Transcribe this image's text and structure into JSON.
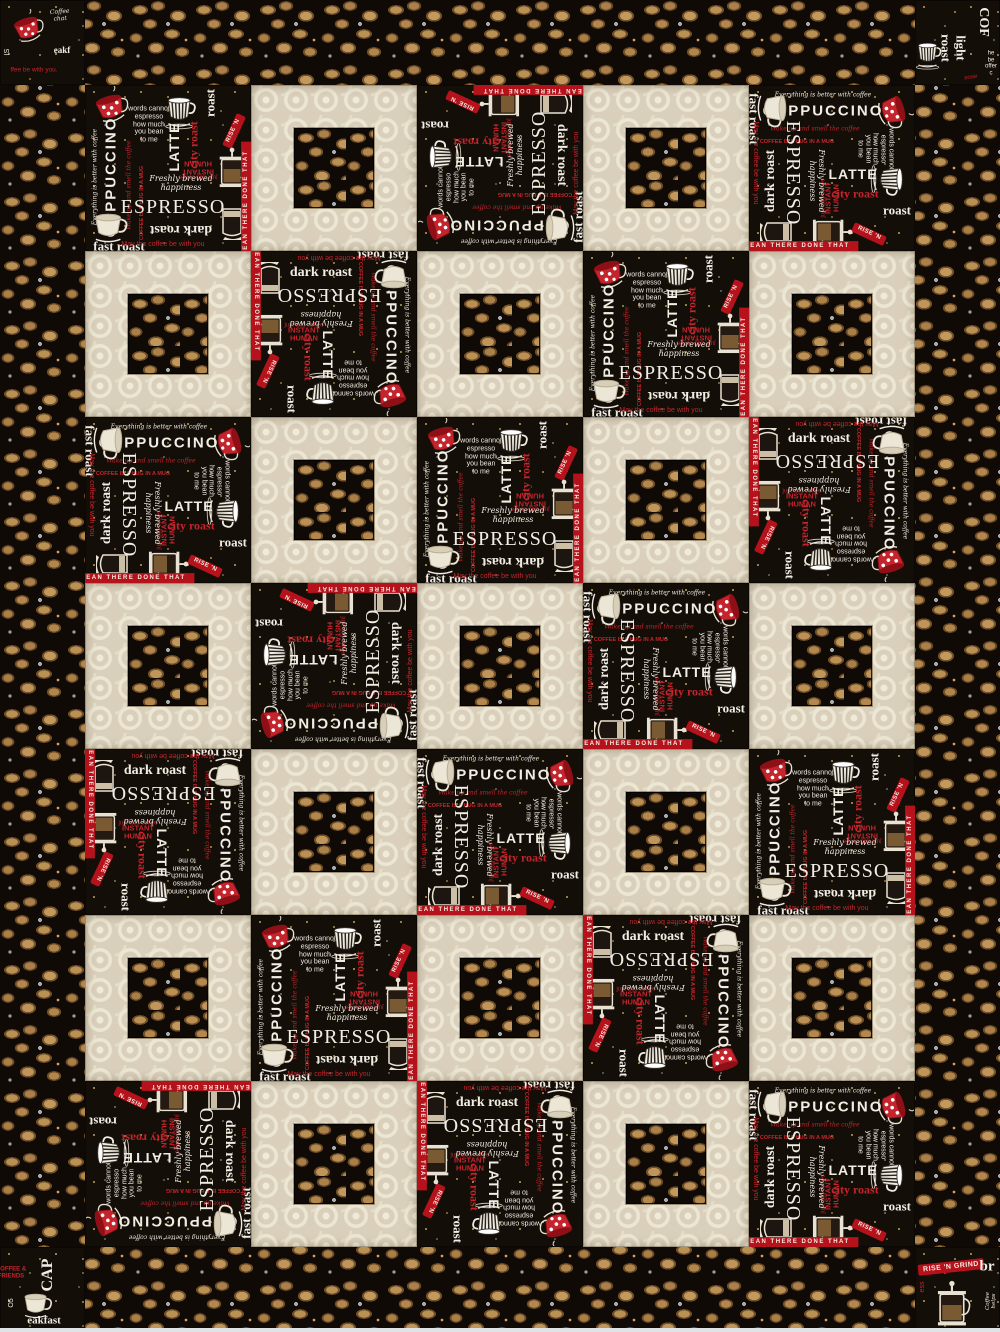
{
  "quilt": {
    "description": "Coffee-themed square-in-a-square quilt",
    "border_width_px": 85,
    "photo_edge_color": "#dfe3e6",
    "grid": {
      "cols": 5,
      "rows": 7,
      "cell_px": 166,
      "pattern": [
        "PCPCP",
        "CPCPC",
        "PCPCP",
        "CPCPC",
        "PCPCP",
        "CPCPC",
        "PCPCP"
      ],
      "orientations": [
        [
          0,
          0,
          270,
          0,
          90
        ],
        [
          0,
          180,
          0,
          0,
          0
        ],
        [
          90,
          0,
          0,
          0,
          180
        ],
        [
          0,
          270,
          0,
          90,
          0
        ],
        [
          180,
          0,
          90,
          0,
          0
        ],
        [
          0,
          0,
          0,
          180,
          0
        ],
        [
          270,
          0,
          180,
          0,
          90
        ]
      ]
    },
    "fabrics": {
      "beans": {
        "name": "coffee bean toss on black",
        "bg": "#0f0a06",
        "bean_light": "#bb9054",
        "bean_dark": "#6f4e26",
        "sprig": "#a9adb2",
        "fleck": "#c9a45e"
      },
      "cream": {
        "name": "cream tonal circle damask",
        "base": "#d9cfbb",
        "motif": "#f0ead9"
      },
      "words": {
        "name": "coffee chalkboard words on black",
        "bg": "#140e09",
        "chalk": "#f1ede3",
        "red": "#c4242b",
        "gold": "#c09a58",
        "items": [
          {
            "kind": "icon",
            "icon": "red-polka-cup",
            "x": 26,
            "y": 24,
            "size": 44,
            "rot": -10
          },
          {
            "kind": "text",
            "t": "words cannot\nespresso\nhow much\nyou bean\nto me",
            "x": 64,
            "y": 40,
            "s": 7,
            "c": "chalk",
            "f": "sans",
            "rot": 0
          },
          {
            "kind": "icon",
            "icon": "striped-cup",
            "x": 96,
            "y": 28,
            "size": 40,
            "rot": 0
          },
          {
            "kind": "text",
            "t": "LATTE",
            "x": 90,
            "y": 62,
            "s": 14,
            "c": "chalk",
            "f": "sans",
            "rot": -90,
            "w": "bold",
            "ls": 1
          },
          {
            "kind": "text",
            "t": "city roast",
            "x": 109,
            "y": 60,
            "s": 12,
            "c": "red",
            "f": "serif",
            "rot": -90,
            "w": "bold"
          },
          {
            "kind": "text",
            "t": "roast",
            "x": 126,
            "y": 18,
            "s": 13,
            "c": "chalk",
            "f": "serif",
            "rot": -90,
            "w": "bold"
          },
          {
            "kind": "banner",
            "t": "RISE 'N",
            "x": 149,
            "y": 46,
            "rot": -65,
            "s": 6
          },
          {
            "kind": "text",
            "t": "INSTANT HUMAN",
            "x": 113,
            "y": 82,
            "s": 7.5,
            "c": "red",
            "f": "sans",
            "rot": 180,
            "w": "bold"
          },
          {
            "kind": "text",
            "t": "just add coffee",
            "x": 113,
            "y": 91,
            "s": 6,
            "c": "red",
            "f": "sans",
            "rot": 180
          },
          {
            "kind": "text",
            "t": "CAPPUCCINO",
            "x": 27,
            "y": 92,
            "s": 15,
            "c": "chalk",
            "f": "sans",
            "rot": -90,
            "w": "bold",
            "ls": 2
          },
          {
            "kind": "text",
            "t": "Everything is better with coffee",
            "x": 11,
            "y": 92,
            "s": 6,
            "c": "chalk",
            "f": "script",
            "rot": -90
          },
          {
            "kind": "text",
            "t": "Wake up and smell the coffee",
            "x": 45,
            "y": 100,
            "s": 6,
            "c": "red",
            "f": "script",
            "rot": -90
          },
          {
            "kind": "text",
            "t": "COFFEE IS A HUG IN A MUG",
            "x": 57,
            "y": 118,
            "s": 5.5,
            "c": "red",
            "f": "sans",
            "rot": -90,
            "w": "bold"
          },
          {
            "kind": "text",
            "t": "Freshly brewed happiness",
            "x": 96,
            "y": 99,
            "s": 8,
            "c": "chalk",
            "f": "script",
            "rot": 0
          },
          {
            "kind": "text",
            "t": "ESPRESSO",
            "x": 88,
            "y": 122,
            "s": 20,
            "c": "chalk",
            "f": "serif",
            "rot": 0,
            "ls": 1
          },
          {
            "kind": "text",
            "t": "dark roast",
            "x": 96,
            "y": 144,
            "s": 14,
            "c": "chalk",
            "f": "serif",
            "rot": 180,
            "w": "bold"
          },
          {
            "kind": "icon",
            "icon": "french-press",
            "x": 148,
            "y": 84,
            "size": 46,
            "rot": 0
          },
          {
            "kind": "icon",
            "icon": "glass-mug",
            "x": 148,
            "y": 138,
            "size": 40,
            "rot": 0
          },
          {
            "kind": "icon",
            "icon": "white-cup",
            "x": 26,
            "y": 142,
            "size": 42,
            "rot": 0
          },
          {
            "kind": "text",
            "t": "fast roast",
            "x": 34,
            "y": 162,
            "s": 13,
            "c": "chalk",
            "f": "serif",
            "rot": 0,
            "w": "bold"
          },
          {
            "kind": "band",
            "t": "BEAN THERE DONE THAT",
            "x": 162,
            "y": 118,
            "rot": -90,
            "s": 6
          },
          {
            "kind": "text",
            "t": "May the coffee be with you",
            "x": 78,
            "y": 160,
            "s": 7,
            "c": "red",
            "f": "sans",
            "rot": 0
          }
        ]
      }
    },
    "corners": {
      "tl": {
        "items": [
          {
            "kind": "icon",
            "icon": "red-polka-cup",
            "x": 28,
            "y": 30,
            "size": 40,
            "rot": -12
          },
          {
            "kind": "text",
            "t": "Coffee chat",
            "x": 60,
            "y": 16,
            "s": 6,
            "c": "chalk",
            "f": "script",
            "rot": -4
          },
          {
            "kind": "text",
            "t": "eakf",
            "x": 62,
            "y": 50,
            "s": 9,
            "c": "chalk",
            "f": "serif",
            "rot": 0,
            "w": "bold"
          },
          {
            "kind": "text",
            "t": "ffee be with you.",
            "x": 34,
            "y": 70,
            "s": 6.5,
            "c": "red",
            "f": "sans",
            "rot": 0
          },
          {
            "kind": "text",
            "t": "IS",
            "x": 8,
            "y": 52,
            "s": 7,
            "c": "chalk",
            "f": "sans",
            "rot": -90
          }
        ]
      },
      "tr": {
        "items": [
          {
            "kind": "text",
            "t": "light roast",
            "x": 38,
            "y": 48,
            "s": 13,
            "c": "chalk",
            "f": "serif",
            "rot": 90,
            "w": "bold"
          },
          {
            "kind": "text",
            "t": "COF",
            "x": 68,
            "y": 22,
            "s": 14,
            "c": "chalk",
            "f": "serif",
            "rot": 90,
            "w": "bold"
          },
          {
            "kind": "icon",
            "icon": "striped-cup",
            "x": 14,
            "y": 56,
            "size": 34,
            "rot": 0
          },
          {
            "kind": "text",
            "t": "he be\noffer c",
            "x": 76,
            "y": 64,
            "s": 6,
            "c": "chalk",
            "f": "sans",
            "rot": 0
          },
          {
            "kind": "text",
            "t": "sose",
            "x": 56,
            "y": 78,
            "s": 6,
            "c": "red",
            "f": "script",
            "rot": -8
          }
        ]
      },
      "bl": {
        "items": [
          {
            "kind": "text",
            "t": "CAP",
            "x": 48,
            "y": 28,
            "s": 16,
            "c": "chalk",
            "f": "serif",
            "rot": -90,
            "w": "bold"
          },
          {
            "kind": "icon",
            "icon": "white-cup",
            "x": 38,
            "y": 58,
            "size": 36,
            "rot": 0
          },
          {
            "kind": "text",
            "t": "eakfast roast",
            "x": 44,
            "y": 80,
            "s": 11,
            "c": "chalk",
            "f": "serif",
            "rot": 0,
            "w": "bold"
          },
          {
            "kind": "text",
            "t": "COFFEE &\nFRIENDS",
            "x": 11,
            "y": 26,
            "s": 6,
            "c": "red",
            "f": "sans",
            "rot": 0,
            "w": "bold"
          },
          {
            "kind": "text",
            "t": "O5",
            "x": 12,
            "y": 56,
            "s": 7,
            "c": "chalk",
            "f": "sans",
            "rot": -90
          }
        ]
      },
      "br": {
        "items": [
          {
            "kind": "banner",
            "t": "RISE 'N GRIND",
            "x": 36,
            "y": 20,
            "rot": -6,
            "s": 7
          },
          {
            "kind": "text",
            "t": "br",
            "x": 72,
            "y": 20,
            "s": 15,
            "c": "chalk",
            "f": "serif",
            "rot": 0,
            "w": "bold"
          },
          {
            "kind": "icon",
            "icon": "french-press",
            "x": 38,
            "y": 58,
            "size": 52,
            "rot": 0
          },
          {
            "kind": "text",
            "t": "Coffee helps",
            "x": 76,
            "y": 54,
            "s": 5.5,
            "c": "chalk",
            "f": "script",
            "rot": -90
          },
          {
            "kind": "text",
            "t": "ess",
            "x": 8,
            "y": 40,
            "s": 7,
            "c": "red",
            "f": "sans",
            "rot": -90
          }
        ]
      }
    }
  }
}
